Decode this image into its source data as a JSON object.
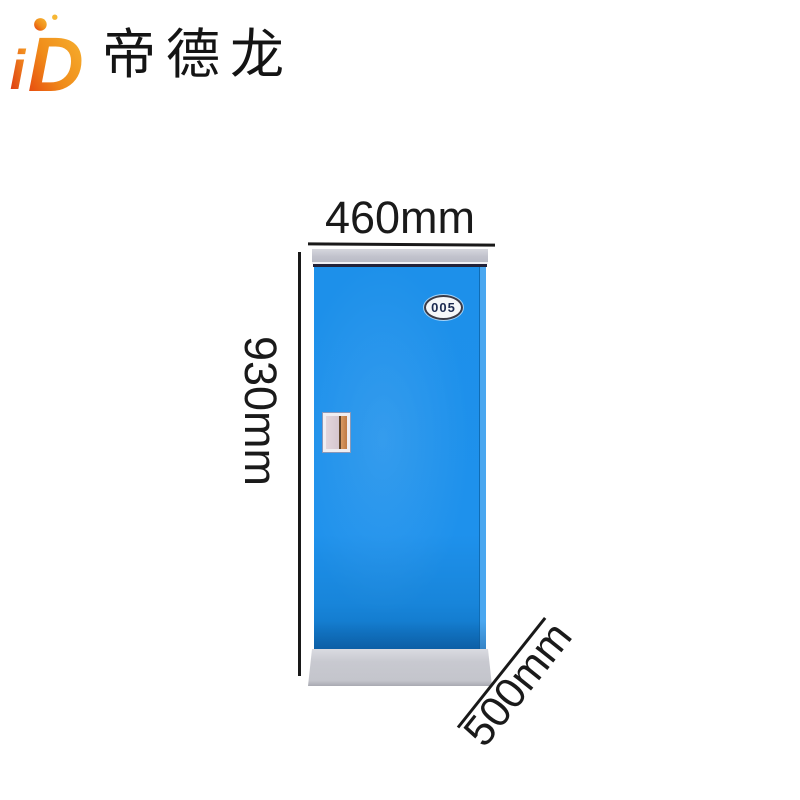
{
  "brand": {
    "logo_i": "i",
    "logo_d": "D",
    "name": "帝德龙"
  },
  "product": {
    "type": "single-door locker cabinet",
    "plate_number": "005"
  },
  "dimensions": {
    "width_label": "460mm",
    "height_label": "930mm",
    "depth_label": "500mm"
  },
  "colors": {
    "cabinet_blue": "#1d90ea",
    "cabinet_blue_side": "#4aa7f0",
    "cap_gray": "#c2c3cd",
    "base_gray": "#c8c9d0",
    "dimension_line": "#191919",
    "logo_orange": "#f7a928",
    "logo_red": "#e8430f",
    "handle_grip": "#c07a43"
  }
}
